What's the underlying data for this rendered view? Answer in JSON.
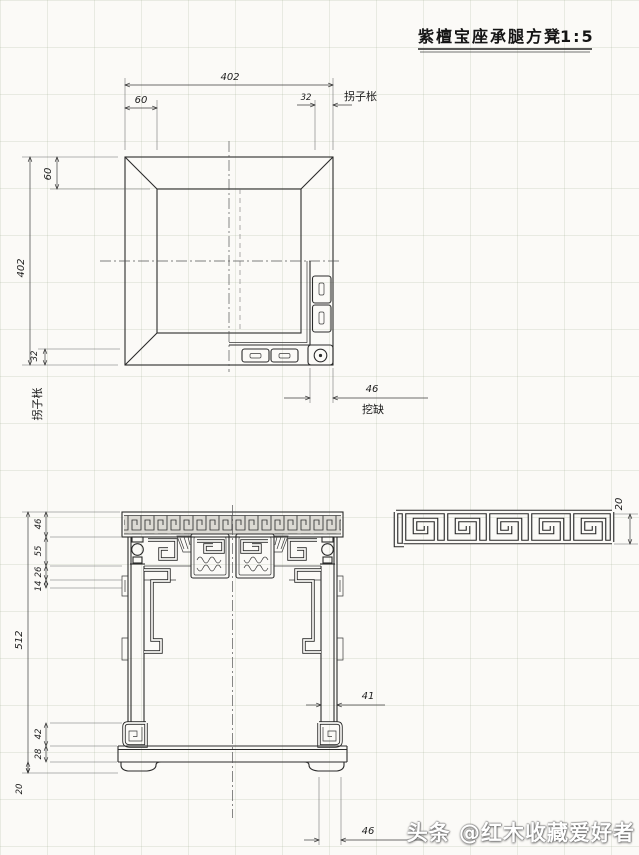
{
  "title": {
    "text": "紫檀宝座承腿方凳",
    "scale": "1:5"
  },
  "plan": {
    "dim_width": "402",
    "dim_frame_top": "60",
    "dim_stretcher_top": "32",
    "label_stretcher_top": "拐子枨",
    "dim_height": "402",
    "dim_frame_left": "60",
    "dim_stretcher_left": "32",
    "label_stretcher_left": "拐子枨",
    "dim_leg_block": "46",
    "label_leg_block": "挖缺"
  },
  "pattern_detail": {
    "dim_height": "20"
  },
  "elevation": {
    "dim_seat": "46",
    "dim_waist": "55",
    "dim_apron": "26",
    "dim_bracket": "14",
    "dim_total": "512",
    "dim_foot_scroll": "42",
    "dim_base": "28",
    "dim_base_foot": "20",
    "dim_leg": "41",
    "dim_foot": "46"
  },
  "watermark": {
    "text": "头条 @红木收藏爱好者"
  }
}
